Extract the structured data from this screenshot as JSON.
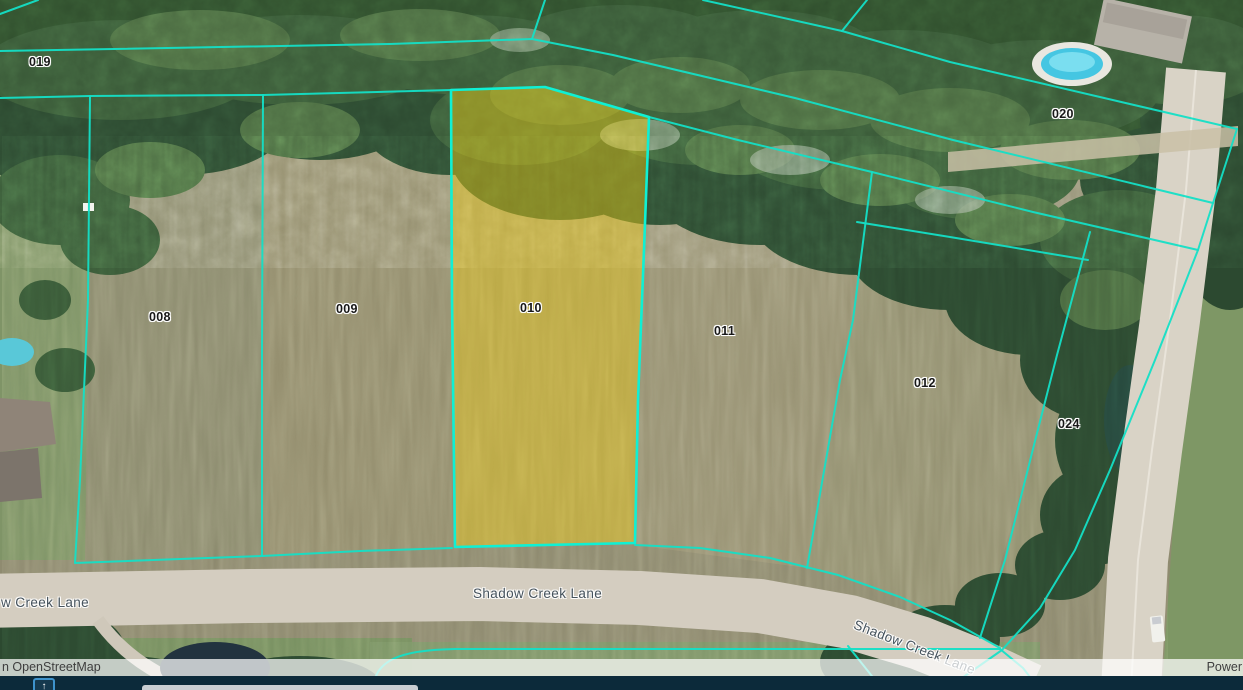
{
  "map": {
    "highlighted_parcel": "010",
    "parcel_labels": [
      {
        "label": "019"
      },
      {
        "label": "020"
      },
      {
        "label": "008"
      },
      {
        "label": "009"
      },
      {
        "label": "010"
      },
      {
        "label": "011"
      },
      {
        "label": "012"
      },
      {
        "label": "024"
      }
    ],
    "street_labels": {
      "left_partial": "w Creek Lane",
      "center": "Shadow Creek Lane",
      "lower_right": "Shadow Creek Lane"
    }
  },
  "attribution": {
    "left_text": "n OpenStreetMap",
    "right_text": "Power"
  },
  "bottom_bar": {
    "expand_button_icon": "↑"
  },
  "theme": {
    "parcel_line_color": "#14dfc6",
    "highlight_stroke_color": "#0ff0d4",
    "highlight_fill_color": "rgba(252,215,20,0.42)",
    "bottom_bar_color": "#0c2a3a",
    "button_border_color": "#3e93cc",
    "attribution_bg": "rgba(255,255,255,0.72)",
    "attribution_text_color": "#3e3e3e",
    "label_text_color": "#181818",
    "street_text_color": "#45525c"
  }
}
